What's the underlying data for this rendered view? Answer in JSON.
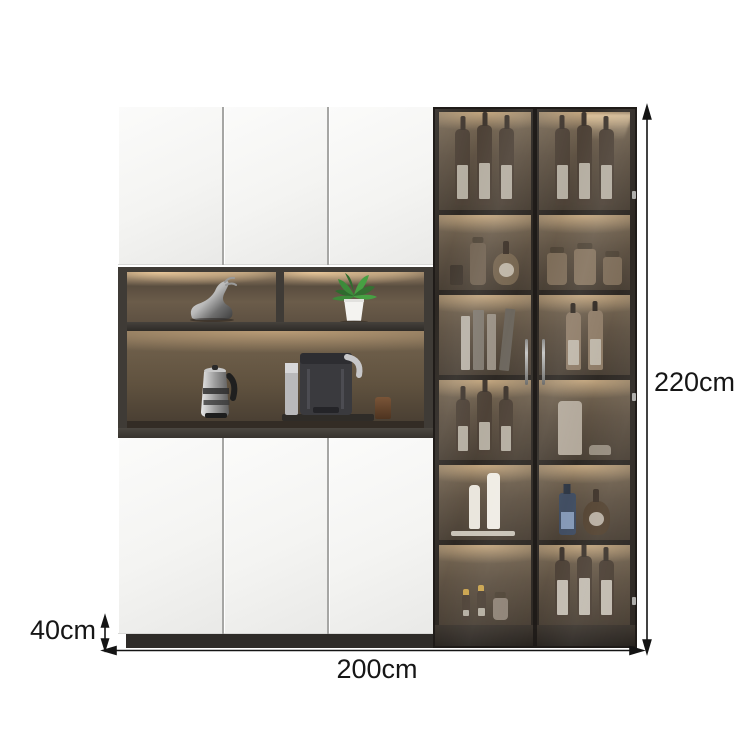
{
  "product": {
    "dimensions": {
      "height_label": "220cm",
      "width_label": "200cm",
      "depth_label": "40cm"
    }
  },
  "colors": {
    "background": "#ffffff",
    "dimension_lines": "#141414",
    "door_white": "#f3f3f1",
    "cabinet_frame": "#3b3733",
    "interior_bronze": "#6a5b4a",
    "led_glow": "#ecc795",
    "glass_tint": "#4a4035",
    "plinth": "#2e2b28"
  },
  "scene": {
    "left_section": {
      "top_doors": 3,
      "bottom_doors": 3,
      "open_shelf_items": [
        "deer-ornament",
        "potted-plant",
        "kettle",
        "coffee-machine",
        "espresso-cup"
      ]
    },
    "glass_section": {
      "doors": 2,
      "shelf_rows": 6,
      "items": [
        "wine-bottles",
        "decanters",
        "storage-jars",
        "books",
        "corked-bottles",
        "vase",
        "bowl",
        "white-vases",
        "liquor-bottles",
        "mini-bottles"
      ]
    }
  }
}
